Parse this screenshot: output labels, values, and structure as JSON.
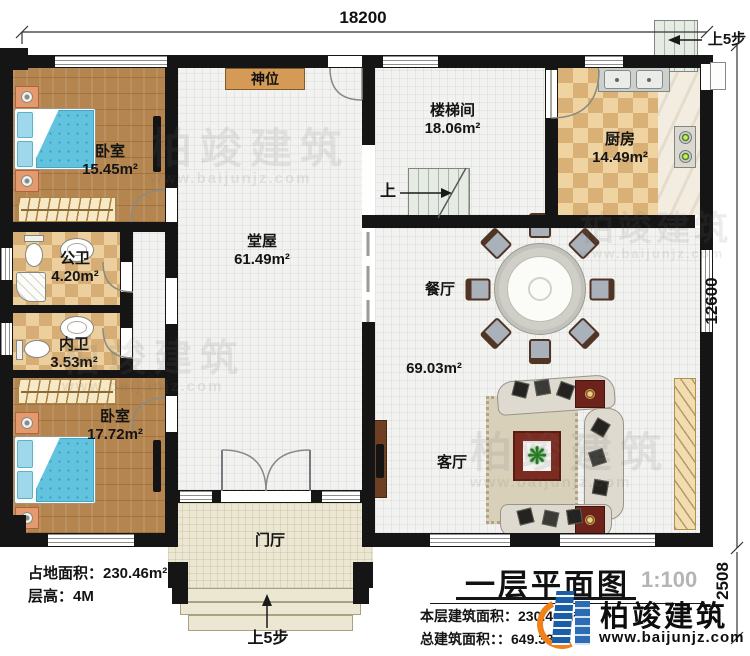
{
  "dimensions": {
    "top": "18200",
    "right_upper": "12600",
    "right_lower": "2508"
  },
  "rooms": {
    "bedroom1": {
      "name": "卧室",
      "area": "15.45m²"
    },
    "public_bath": {
      "name": "公卫",
      "area": "4.20m²"
    },
    "inner_bath": {
      "name": "内卫",
      "area": "3.53m²"
    },
    "bedroom2": {
      "name": "卧室",
      "area": "17.72m²"
    },
    "hall": {
      "name": "堂屋",
      "area": "61.49m²"
    },
    "stair_hall": {
      "name": "楼梯间",
      "area": "18.06m²"
    },
    "kitchen": {
      "name": "厨房",
      "area": "14.49m²"
    },
    "dining": {
      "name": "餐厅"
    },
    "living": {
      "name": "客厅",
      "combined_area": "69.03m²"
    },
    "foyer": {
      "name": "门厅"
    }
  },
  "labels": {
    "shrine": "神位",
    "stairs_up": "上",
    "steps_up_right": "上5步",
    "steps_up_bottom": "上5步"
  },
  "info": {
    "land_area": "占地面积：230.46m²",
    "floor_height": "层高：4M",
    "floor_area": "本层建筑面积：230.46m²",
    "total_area": "总建筑面积：：649.33m²"
  },
  "title_block": {
    "title": "一层平面图",
    "scale": "1:100"
  },
  "brand": {
    "name": "柏竣建筑",
    "website": "www.baijunjz.com"
  },
  "watermark": {
    "text": "柏竣建筑",
    "website": "www.baijunjz.com"
  },
  "icons": {
    "plant": "❋"
  },
  "colors": {
    "wall": "#151515",
    "wood": "#b5854f",
    "checker": "#d6ad74",
    "shrine": "#d59b56",
    "bed": "#62c3de",
    "logo_blue": "#1b5ea6",
    "logo_orange": "#f08018"
  }
}
